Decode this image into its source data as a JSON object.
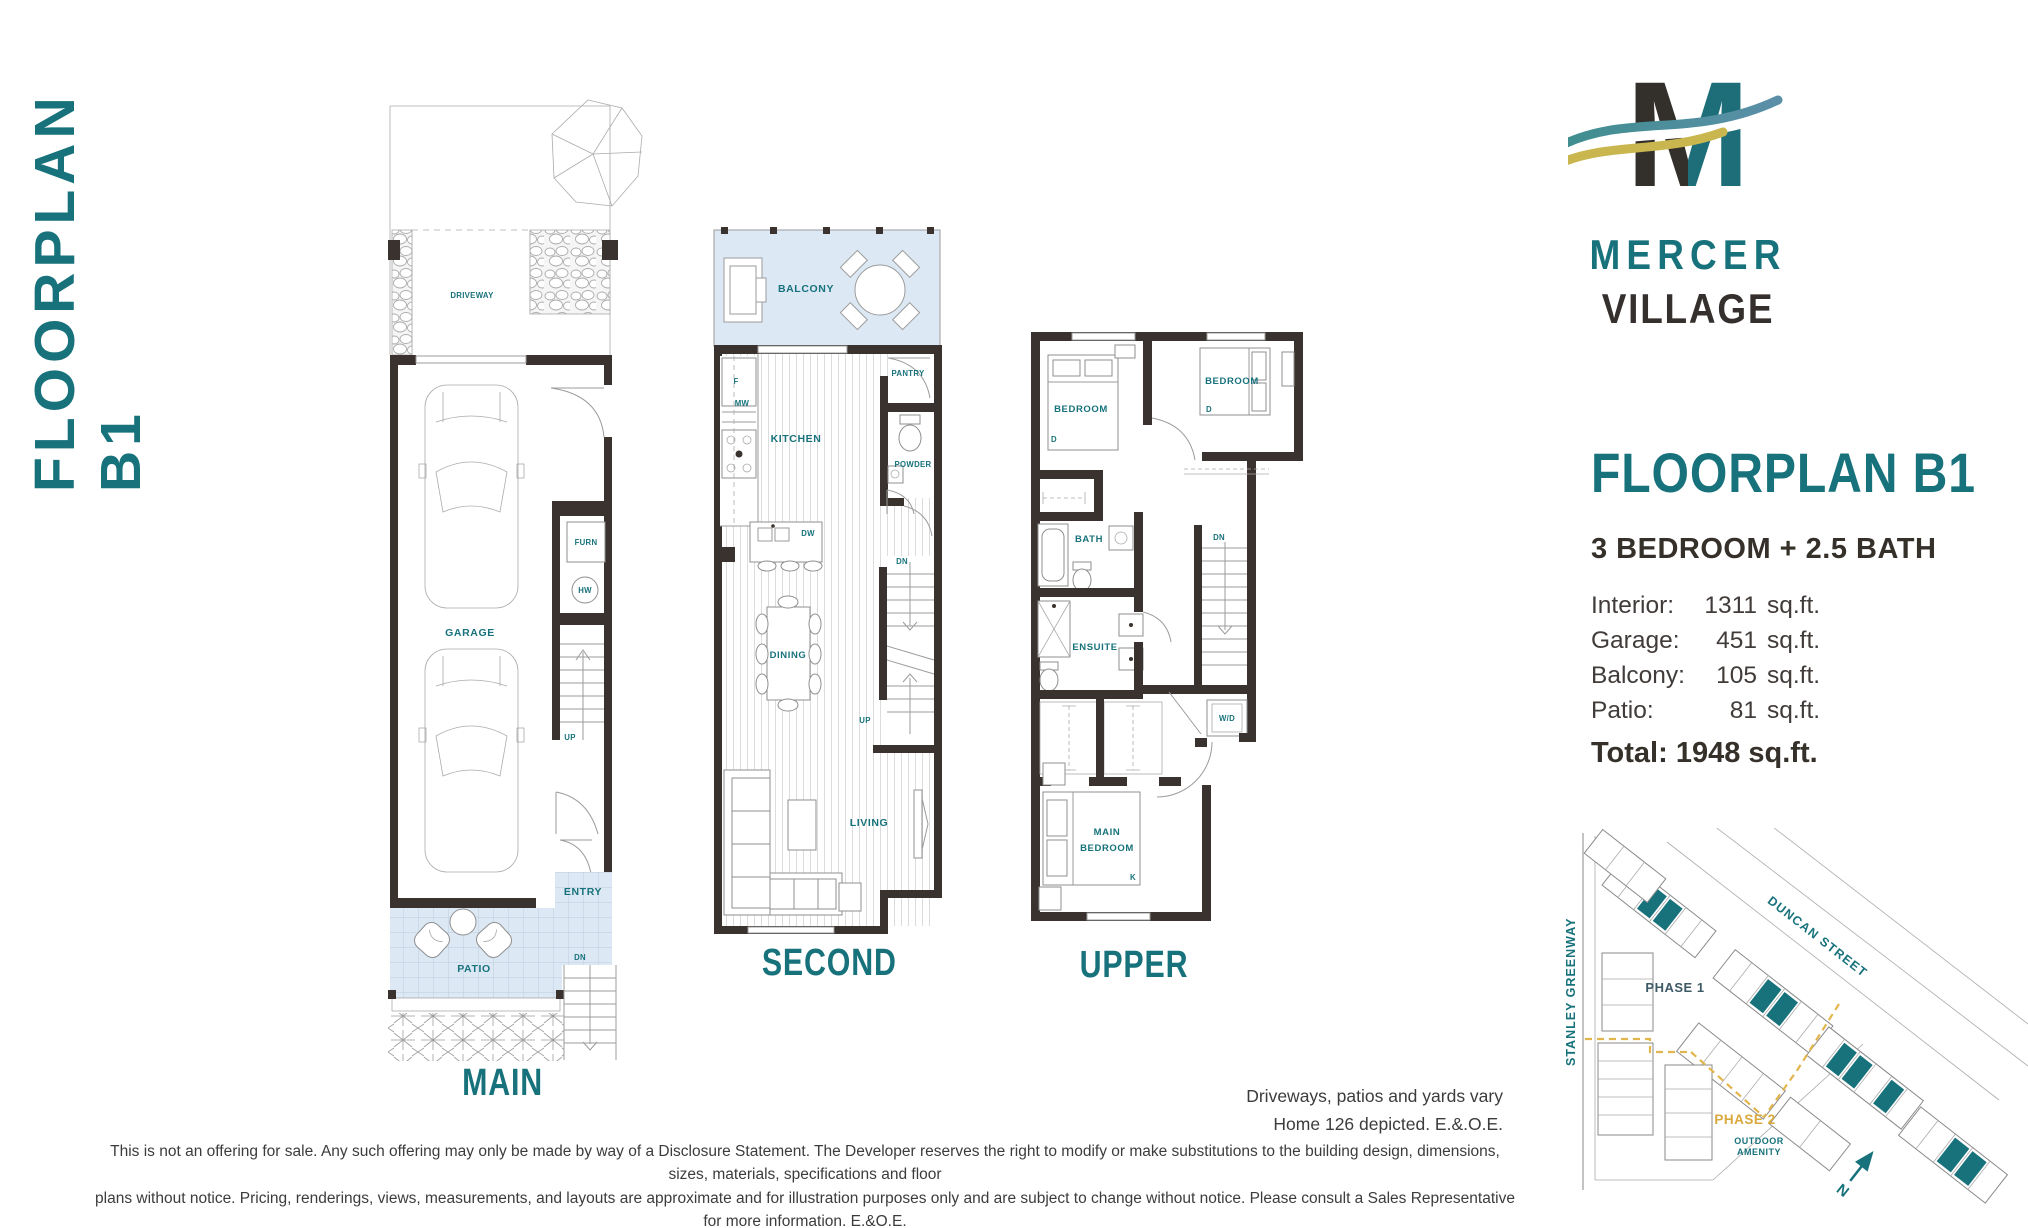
{
  "page": {
    "side_title": "FLOORPLAN B1"
  },
  "brand": {
    "monogram": "M",
    "name_line1": "MERCER",
    "name_line2": "VILLAGE"
  },
  "details": {
    "title": "FLOORPLAN B1",
    "subtitle": "3 BEDROOM + 2.5 BATH",
    "stats": [
      {
        "label": "Interior:",
        "value": "1311",
        "unit": "sq.ft."
      },
      {
        "label": "Garage:",
        "value": "451",
        "unit": "sq.ft."
      },
      {
        "label": "Balcony:",
        "value": "105",
        "unit": "sq.ft."
      },
      {
        "label": "Patio:",
        "value": "81",
        "unit": "sq.ft."
      }
    ],
    "total": "Total: 1948 sq.ft."
  },
  "plans": {
    "main": {
      "caption": "MAIN",
      "labels": {
        "driveway": "DRIVEWAY",
        "garage": "GARAGE",
        "furn": "FURN",
        "hw": "HW",
        "up": "UP",
        "entry": "ENTRY",
        "dn": "DN",
        "patio": "PATIO"
      }
    },
    "second": {
      "caption": "SECOND",
      "labels": {
        "balcony": "BALCONY",
        "f": "F",
        "mw": "MW",
        "kitchen": "KITCHEN",
        "pantry": "PANTRY",
        "powder": "POWDER",
        "dw": "DW",
        "dn": "DN",
        "dining": "DINING",
        "up": "UP",
        "living": "LIVING"
      }
    },
    "upper": {
      "caption": "UPPER",
      "labels": {
        "bedroom_left": "BEDROOM",
        "d_left": "D",
        "bedroom_right": "BEDROOM",
        "d_right": "D",
        "bath": "BATH",
        "dn": "DN",
        "ensuite": "ENSUITE",
        "wd": "W/D",
        "main_bedroom_line1": "MAIN",
        "main_bedroom_line2": "BEDROOM",
        "k": "K"
      }
    }
  },
  "sitemap": {
    "street_left": "STANLEY GREENWAY",
    "street_top": "DUNCAN STREET",
    "phase1": "PHASE 1",
    "phase2": "PHASE 2",
    "outdoor_amenity_line1": "OUTDOOR",
    "outdoor_amenity_line2": "AMENITY",
    "north": "N"
  },
  "notes": {
    "vary_line1": "Driveways, patios and yards vary",
    "vary_line2": "Home 126 depicted. E.&.O.E.",
    "disclaimer_line1": "This is not an offering for sale. Any such offering may only be made by way of a Disclosure Statement. The Developer reserves the right to modify or make substitutions to the building design, dimensions, sizes, materials, specifications and floor",
    "disclaimer_line2": "plans without notice. Pricing, renderings, views, measurements, and layouts are approximate and for illustration purposes only and are subject to change without notice. Please consult a Sales Representative for more information. E.&O.E."
  },
  "colors": {
    "teal": "#17727C",
    "charcoal": "#35302D",
    "gold": "#DFB64B",
    "light_blue": "#DCE8F4",
    "wall": "#3A322E"
  }
}
